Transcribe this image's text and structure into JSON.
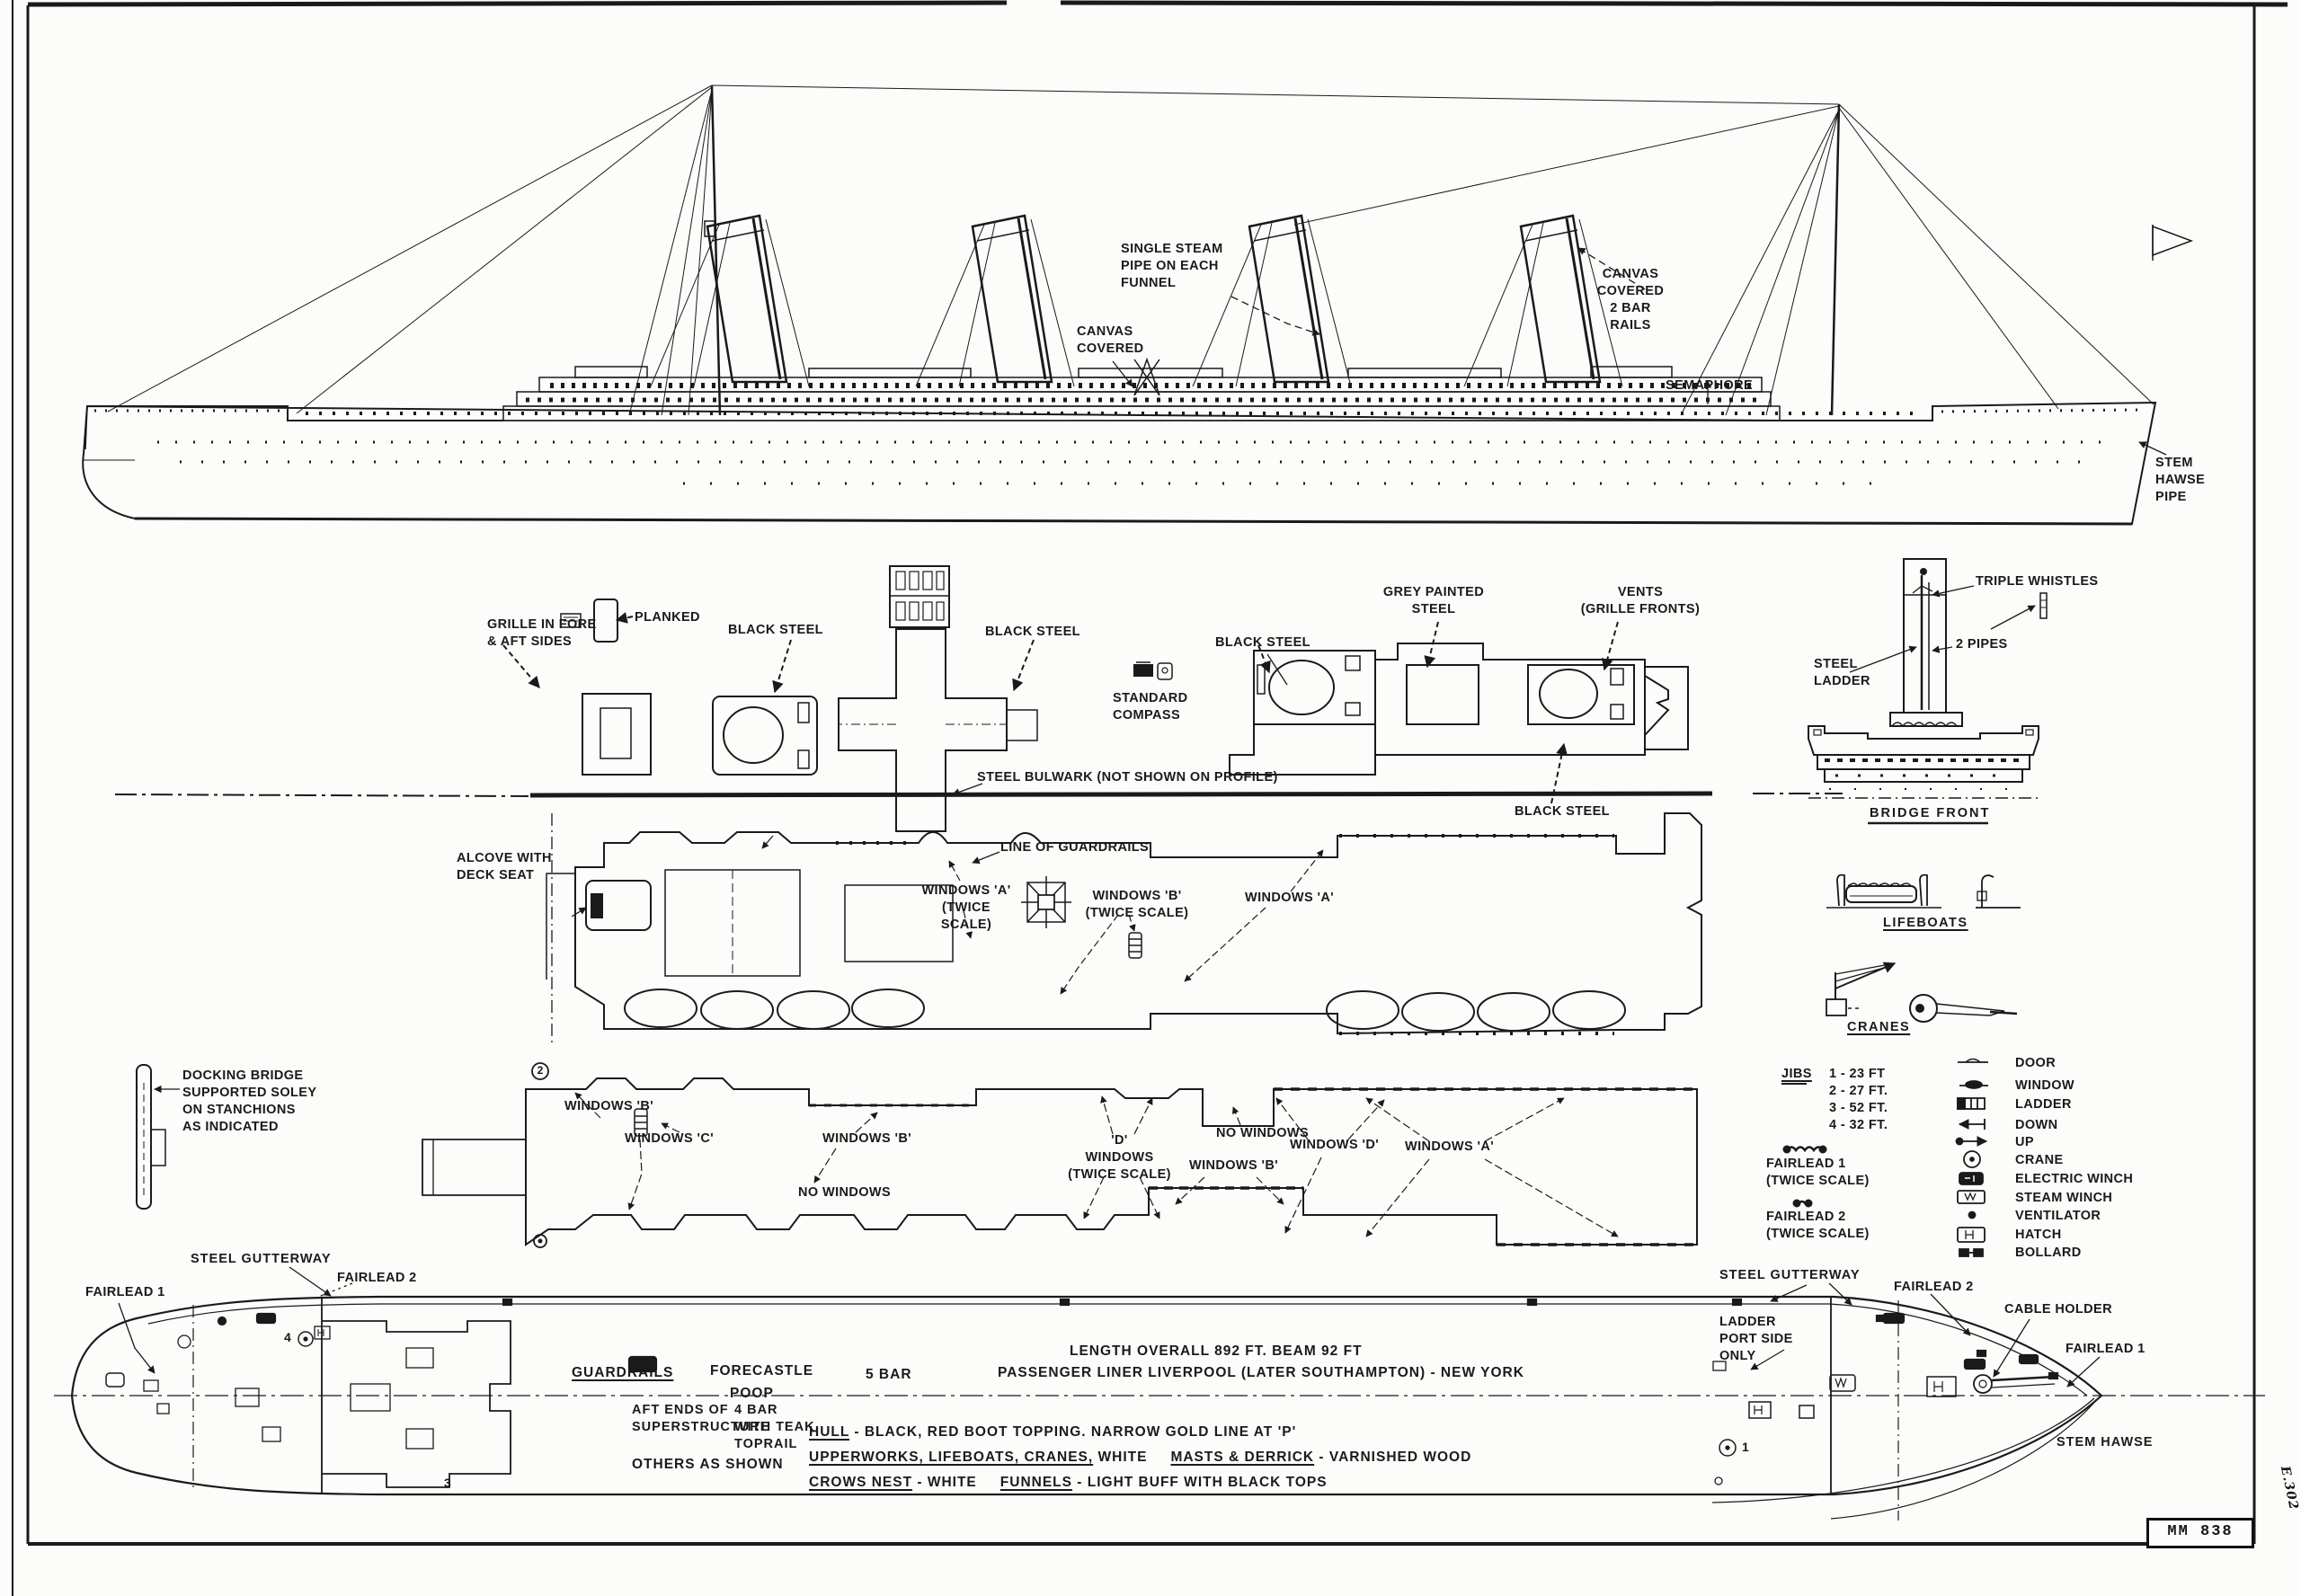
{
  "profile": {
    "single_steam_pipe": "SINGLE STEAM\nPIPE ON EACH\nFUNNEL",
    "canvas_covered": "CANVAS\nCOVERED",
    "canvas_covered_rails": "CANVAS\nCOVERED\n2 BAR\nRAILS",
    "semaphore": "SEMAPHORE",
    "stem_hawse_pipe": "STEM\nHAWSE\nPIPE"
  },
  "funnel_details": {
    "planked": "PLANKED",
    "grille": "GRILLE IN FORE\n& AFT SIDES",
    "black_steel_1": "BLACK STEEL",
    "black_steel_2": "BLACK STEEL",
    "black_steel_3": "BLACK STEEL",
    "black_steel_4": "BLACK STEEL",
    "grey_painted": "GREY PAINTED\nSTEEL",
    "vents": "VENTS\n(GRILLE FRONTS)",
    "standard_compass": "STANDARD\nCOMPASS"
  },
  "bridge": {
    "triple_whistles": "TRIPLE WHISTLES",
    "two_pipes": "2 PIPES",
    "steel_ladder": "STEEL\nLADDER",
    "title": "BRIDGE FRONT"
  },
  "boat_deck": {
    "steel_bulwark": "STEEL BULWARK (NOT SHOWN ON PROFILE)",
    "alcove": "ALCOVE WITH\nDECK SEAT",
    "line_of_guardrails": "LINE OF GUARDRAILS",
    "windows_a_twice": "WINDOWS 'A'\n(TWICE SCALE)",
    "windows_b_twice": "WINDOWS 'B'\n(TWICE SCALE)",
    "windows_a": "WINDOWS 'A'"
  },
  "promenade_deck": {
    "docking_bridge": "DOCKING BRIDGE\nSUPPORTED SOLEY\nON STANCHIONS\nAS INDICATED",
    "windows_b_1": "WINDOWS 'B'",
    "windows_c": "WINDOWS 'C'",
    "windows_b_2": "WINDOWS 'B'",
    "no_windows_1": "NO WINDOWS",
    "d_windows": "'D'\nWINDOWS\n(TWICE SCALE)",
    "windows_b_3": "WINDOWS 'B'",
    "no_windows_2": "NO WINDOWS",
    "windows_d": "WINDOWS 'D'",
    "windows_a": "WINDOWS 'A'",
    "marker_2": "2"
  },
  "aux_details": {
    "lifeboats": "LIFEBOATS",
    "cranes": "CRANES"
  },
  "jibs": {
    "title": "JIBS",
    "rows": [
      "1 - 23 FT",
      "2 - 27 FT.",
      "3 - 52 FT.",
      "4 - 32 FT."
    ]
  },
  "fairlead_details": {
    "f1": "FAIRLEAD 1\n(TWICE SCALE)",
    "f2": "FAIRLEAD 2\n(TWICE SCALE)"
  },
  "legend": {
    "items": [
      {
        "symbol": "door-symbol",
        "label": "DOOR"
      },
      {
        "symbol": "window-symbol",
        "label": "WINDOW"
      },
      {
        "symbol": "ladder-symbol",
        "label": "LADDER"
      },
      {
        "symbol": "down-symbol",
        "label": "DOWN"
      },
      {
        "symbol": "up-symbol",
        "label": "UP"
      },
      {
        "symbol": "crane-symbol",
        "label": "CRANE"
      },
      {
        "symbol": "electric-winch-symbol",
        "label": "ELECTRIC WINCH"
      },
      {
        "symbol": "steam-winch-symbol",
        "label": "STEAM WINCH"
      },
      {
        "symbol": "ventilator-symbol",
        "label": "VENTILATOR"
      },
      {
        "symbol": "hatch-symbol",
        "label": "HATCH"
      },
      {
        "symbol": "bollard-symbol",
        "label": "BOLLARD"
      }
    ]
  },
  "hull_plan": {
    "steel_gutterway_left": "STEEL GUTTERWAY",
    "fairlead_2_left": "FAIRLEAD 2",
    "fairlead_1_left": "FAIRLEAD 1",
    "steel_gutterway_right": "STEEL GUTTERWAY",
    "fairlead_2_right": "FAIRLEAD 2",
    "cable_holder": "CABLE HOLDER",
    "fairlead_1_right": "FAIRLEAD 1",
    "stem_hawse": "STEM HAWSE",
    "ladder_port": "LADDER\nPORT SIDE\nONLY",
    "marker_4": "4",
    "marker_3": "3",
    "marker_1": "1"
  },
  "specs": {
    "length_beam": "LENGTH  OVERALL  892 FT.   BEAM  92 FT",
    "guardrails": "GUARDRAILS",
    "forecastle": "FORECASTLE",
    "poop": "POOP",
    "five_bar": "5 BAR",
    "liner": "PASSENGER  LINER   LIVERPOOL  (LATER  SOUTHAMPTON) - NEW  YORK",
    "aft_ends": "AFT ENDS OF\nSUPERSTRUCTURE",
    "four_bar": "4 BAR\nWITH TEAK\nTOPRAIL",
    "others": "OTHERS  AS  SHOWN",
    "hull_u": "HULL",
    "hull_rest": " - BLACK,  RED  BOOT  TOPPING.   NARROW  GOLD  LINE  AT  'P'",
    "upper_u": "UPPERWORKS, LIFEBOATS, CRANES,",
    "upper_mid": " WHITE",
    "masts_u": "MASTS & DERRICK",
    "masts_rest": " - VARNISHED  WOOD",
    "crows_u": "CROWS NEST",
    "crows_mid": " - WHITE",
    "funnels_u": "FUNNELS",
    "funnels_rest": " - LIGHT  BUFF  WITH  BLACK  TOPS"
  },
  "title_block": {
    "number": "MM 838",
    "margin_note": "E.302"
  }
}
